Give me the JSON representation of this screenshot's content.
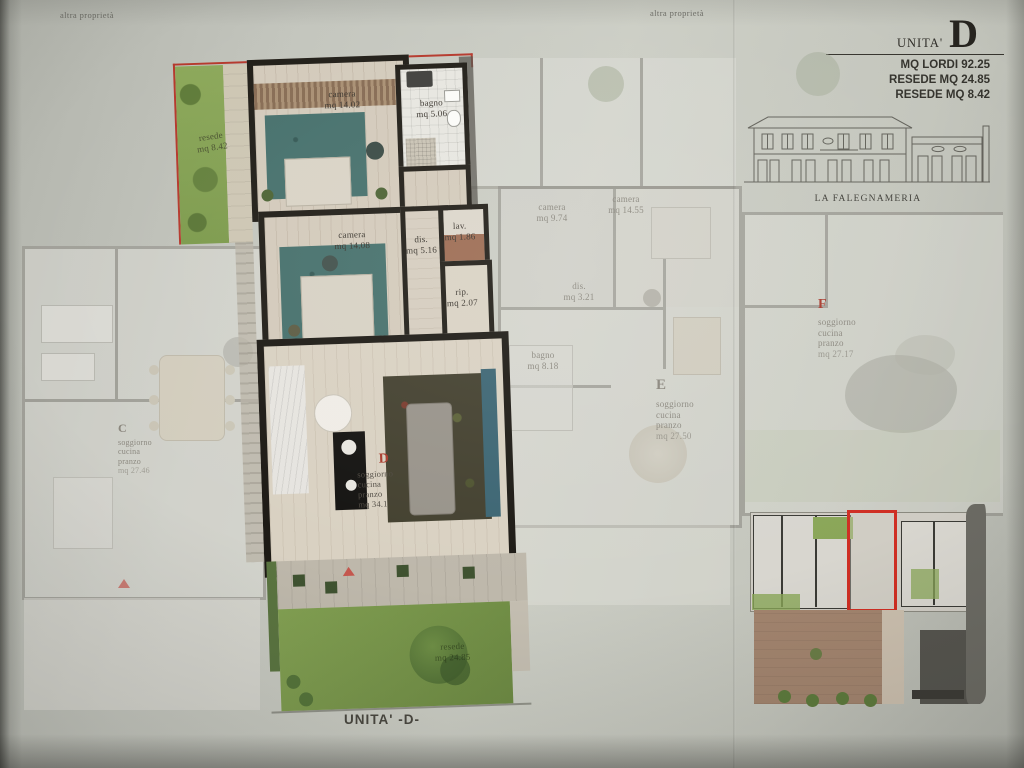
{
  "annotations": {
    "altra_proprieta_left": "altra proprietà",
    "altra_proprieta_center": "altra proprietà",
    "unita_footer": "UNITA' -D-"
  },
  "header": {
    "unit_word": "UNITA'",
    "unit_letter": "D",
    "stat1": "MQ LORDI 92.25",
    "stat2": "RESEDE MQ 24.85",
    "stat3": "RESEDE MQ 8.42"
  },
  "elevation": {
    "caption": "LA FALEGNAMERIA"
  },
  "unit_d": {
    "resede_top": {
      "name": "resede",
      "area": "mq 8.42"
    },
    "camera_top": {
      "name": "camera",
      "area": "mq 14.02"
    },
    "bagno": {
      "name": "bagno",
      "area": "mq 5.06"
    },
    "camera_mid": {
      "name": "camera",
      "area": "mq 14.08"
    },
    "dis": {
      "name": "dis.",
      "area": "mq 5.16"
    },
    "lav": {
      "name": "lav.",
      "area": "mq 1.86"
    },
    "rip": {
      "name": "rip.",
      "area": "mq 2.07"
    },
    "living": {
      "letter": "D",
      "line1": "soggiorno",
      "line2": "cucina",
      "line3": "pranzo",
      "area": "mq 34.1"
    },
    "garden": {
      "name": "resede",
      "area": "mq 24.85"
    }
  },
  "unit_c": {
    "letter": "C",
    "line1": "soggiorno",
    "line2": "cucina",
    "line3": "pranzo",
    "area": "mq 27.46"
  },
  "unit_e": {
    "letter": "E",
    "line1": "soggiorno",
    "line2": "cucina",
    "line3": "pranzo",
    "area": "mq 27.50",
    "camera_left": {
      "name": "camera",
      "area": "mq 9.74"
    },
    "camera_right": {
      "name": "camera",
      "area": "mq 14.55"
    },
    "dis": {
      "name": "dis.",
      "area": "mq 3.21"
    },
    "bagno": {
      "name": "bagno",
      "area": "mq 8.18"
    }
  },
  "unit_f": {
    "letter": "F",
    "line1": "soggiorno",
    "line2": "cucina",
    "line3": "pranzo",
    "area": "mq 27.17"
  },
  "colors": {
    "paper": "#c4c6bd",
    "red_accent": "#c0392b",
    "wall_black": "#211e18",
    "teal_rug": "#46706c",
    "grass": "#7f9c50",
    "wood_floor": "#d3cabb",
    "faded_wall": "#8f8d86"
  }
}
